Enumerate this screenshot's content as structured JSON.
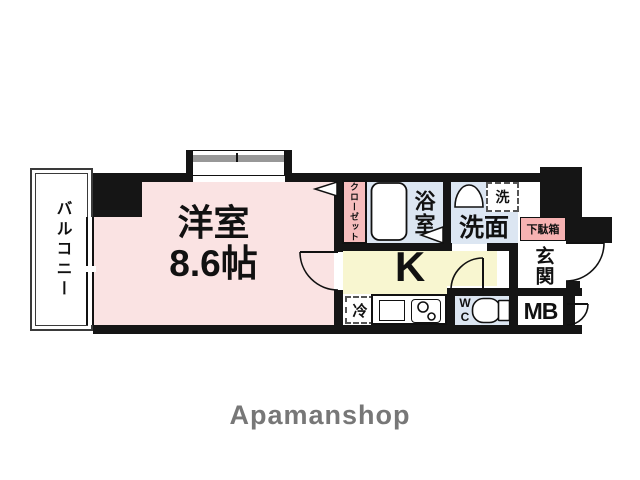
{
  "rooms": {
    "balcony": {
      "label": "バルコニー"
    },
    "main_room": {
      "label": "洋室",
      "size": "8.6帖"
    },
    "closet": {
      "label": "クローゼット"
    },
    "bathroom": {
      "label": "浴室"
    },
    "washroom": {
      "label": "洗面"
    },
    "washing_machine": {
      "label": "洗"
    },
    "kitchen": {
      "label": "K"
    },
    "refrigerator": {
      "label": "冷"
    },
    "toilet": {
      "line1": "W",
      "line2": "C"
    },
    "shoe_box": {
      "label": "下駄箱"
    },
    "entrance": {
      "label": "玄関"
    },
    "meter_box": {
      "label": "MB"
    }
  },
  "branding": {
    "logo": "Apamanshop"
  },
  "colors": {
    "wall": "#151515",
    "room_pink": "#fae3e3",
    "closet_pink": "#f6bdbd",
    "shoebox_pink": "#f6b2b2",
    "wet_blue": "#dce6f2",
    "kitchen_yellow": "#f8f6d0",
    "window_gray": "#989898",
    "logo_gray": "#777777"
  }
}
